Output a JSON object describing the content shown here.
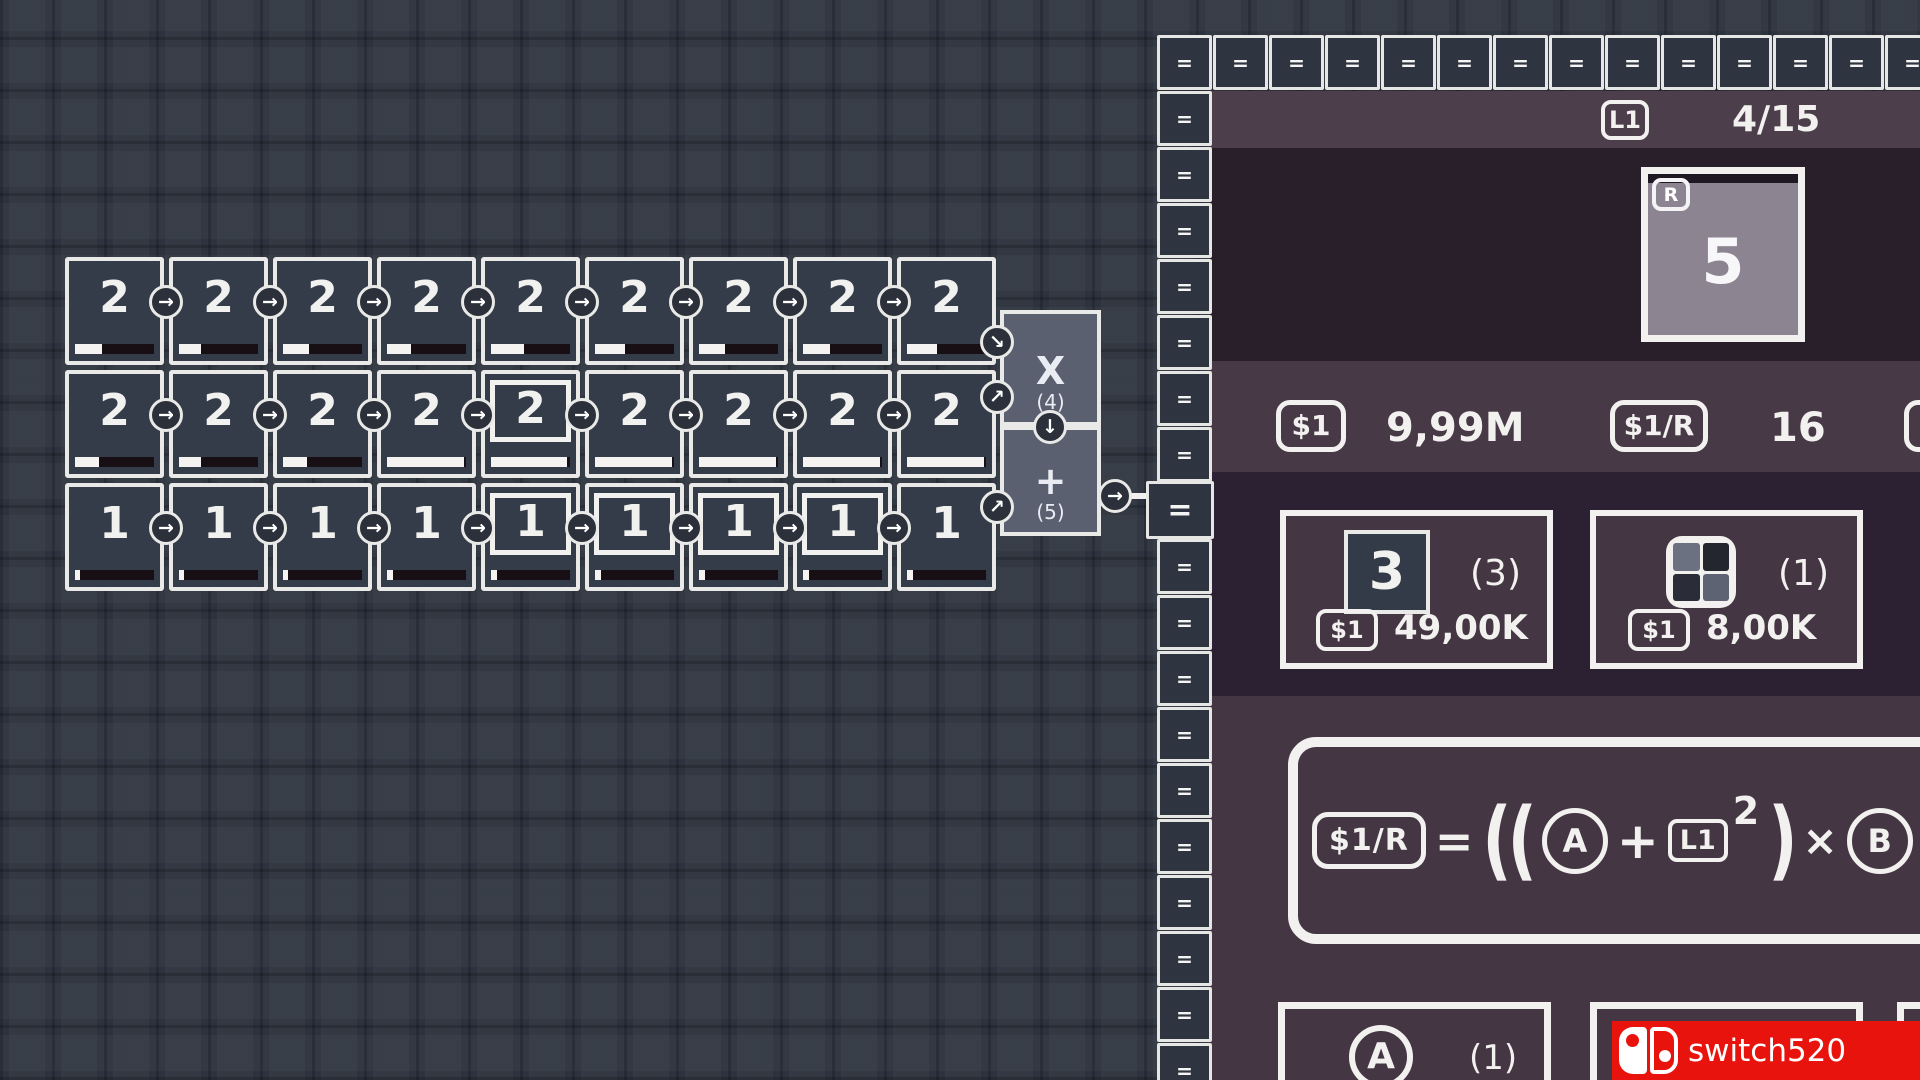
{
  "grid": {
    "cols": 9,
    "arrow_icon": "→",
    "rows": [
      {
        "value": "2",
        "bars": [
          34,
          28,
          33,
          31,
          42,
          38,
          33,
          34,
          38
        ],
        "highlights": []
      },
      {
        "value": "2",
        "bars": [
          30,
          28,
          30,
          97,
          96,
          97,
          97,
          97,
          97
        ],
        "highlights": [
          4
        ]
      },
      {
        "value": "1",
        "bars": [
          6,
          6,
          6,
          7,
          7,
          7,
          7,
          8,
          8
        ],
        "highlights": [
          4,
          5,
          6,
          7
        ]
      }
    ]
  },
  "processor": {
    "multiply": {
      "symbol": "X",
      "count": "(4)"
    },
    "add": {
      "symbol": "+",
      "count": "(5)"
    },
    "down_arrow": "↓",
    "out_arrow": "→",
    "row_arrows": [
      "↘",
      "↗",
      "↗"
    ]
  },
  "panel": {
    "border_glyph": "=",
    "header": {
      "badge": "L1",
      "progress": "4/15"
    },
    "reward_tile": {
      "badge": "R",
      "value": "5"
    },
    "currency": [
      {
        "badge": "$1",
        "value": "9,99M"
      },
      {
        "badge": "$1/R",
        "value": "16"
      }
    ],
    "shop": [
      {
        "tile": "3",
        "owned": "(3)",
        "price_badge": "$1",
        "price": "49,00K"
      },
      {
        "owned": "(1)",
        "price_badge": "$1",
        "price": "8,00K"
      }
    ],
    "formula": {
      "result": "$1/R",
      "eq": "=",
      "open": "((",
      "a": "A",
      "plus": "+",
      "base": "L1",
      "exp": "2",
      "close": ")",
      "times": "×",
      "b": "B",
      "tail": ")"
    },
    "slots": [
      {
        "label": "A",
        "count": "(1)"
      },
      {
        "label": "B",
        "count": ""
      }
    ]
  },
  "watermark": {
    "text": "switch520"
  },
  "colors": {
    "chalk": "#f2f1ef",
    "tile_fill": "#353c49",
    "proc_fill": "#5b6070",
    "panel_bar": "#4c3e4a",
    "panel_dark": "#281f2b",
    "panel_strip": "#473a46",
    "panel_dark2": "#2c2132",
    "panel_light": "#443743",
    "reward_fill": "#8c8491",
    "watermark_red": "#e9130d"
  }
}
